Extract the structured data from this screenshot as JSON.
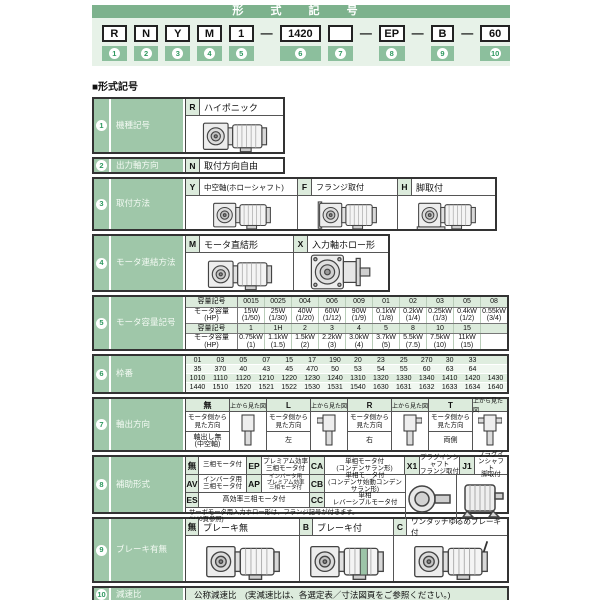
{
  "banner": {
    "title": "形 式 記 号",
    "dash": "—",
    "segments": [
      {
        "text": "R",
        "num": "1"
      },
      {
        "text": "N",
        "num": "2"
      },
      {
        "text": "Y",
        "num": "3"
      },
      {
        "text": "M",
        "num": "4"
      },
      {
        "text": "1",
        "num": "5"
      },
      {
        "text": "1420",
        "num": "6"
      },
      {
        "text": "",
        "num": "7"
      },
      {
        "text": "EP",
        "num": "8"
      },
      {
        "text": "B",
        "num": "9"
      },
      {
        "text": "60",
        "num": "10"
      }
    ]
  },
  "section_heading": "■形式記号",
  "rows": {
    "r1": {
      "num": "1",
      "label": "機種記号",
      "code": "R",
      "desc": "ハイポニック"
    },
    "r2": {
      "num": "2",
      "label": "出力軸方向",
      "code": "N",
      "desc": "取付方向自由"
    },
    "r3": {
      "num": "3",
      "label": "取付方法",
      "opts": [
        {
          "code": "Y",
          "desc": "中空軸(ホローシャフト)"
        },
        {
          "code": "F",
          "desc": "フランジ取付"
        },
        {
          "code": "H",
          "desc": "脚取付"
        }
      ]
    },
    "r4": {
      "num": "4",
      "label": "モータ連結方法",
      "opts": [
        {
          "code": "M",
          "desc": "モータ直結形"
        },
        {
          "code": "X",
          "desc": "入力軸ホロー形"
        }
      ]
    },
    "r5": {
      "num": "5",
      "label": "モータ容量記号",
      "code_label": "容量記号",
      "cap_label": "モータ容量\n(HP)",
      "codes1": [
        "0015",
        "0025",
        "004",
        "006",
        "009",
        "01",
        "02",
        "03",
        "05",
        "08"
      ],
      "caps1": [
        "15W\n(1/50)",
        "25W\n(1/30)",
        "40W\n(1/20)",
        "60W\n(1/12)",
        "90W\n(1/9)",
        "0.1kW\n(1/8)",
        "0.2kW\n(1/4)",
        "0.25kW\n(1/3)",
        "0.4kW\n(1/2)",
        "0.55kW\n(3/4)"
      ],
      "codes2": [
        "1",
        "1H",
        "2",
        "3",
        "4",
        "5",
        "8",
        "10",
        "15",
        ""
      ],
      "caps2": [
        "0.75kW\n(1)",
        "1.1kW\n(1.5)",
        "1.5kW\n(2)",
        "2.2kW\n(3)",
        "3.0kW\n(4)",
        "3.7kW\n(5)",
        "5.5kW\n(7.5)",
        "7.5kW\n(10)",
        "11kW\n(15)",
        ""
      ]
    },
    "r6": {
      "num": "6",
      "label": "枠番",
      "grid": [
        [
          "01",
          "03",
          "05",
          "07",
          "15",
          "17",
          "190",
          "20",
          "23",
          "25",
          "270",
          "30",
          "33",
          ""
        ],
        [
          "35",
          "370",
          "40",
          "43",
          "45",
          "470",
          "50",
          "53",
          "54",
          "55",
          "60",
          "63",
          "64",
          ""
        ],
        [
          "1010",
          "1110",
          "1120",
          "1210",
          "1220",
          "1230",
          "1240",
          "1310",
          "1320",
          "1330",
          "1340",
          "1410",
          "1420",
          "1430"
        ],
        [
          "1440",
          "1510",
          "1520",
          "1521",
          "1522",
          "1530",
          "1531",
          "1540",
          "1630",
          "1631",
          "1632",
          "1633",
          "1634",
          "1640"
        ]
      ]
    },
    "r7": {
      "num": "7",
      "label": "軸出方向",
      "top_view": "上から見た図",
      "motor_side": "モータ側から\n見た方向",
      "opts": [
        {
          "code": "無",
          "value": "軸出し無\n(中空軸)"
        },
        {
          "code": "L",
          "value": "左"
        },
        {
          "code": "R",
          "value": "右"
        },
        {
          "code": "T",
          "value": "両側"
        }
      ]
    },
    "r8": {
      "num": "8",
      "label": "補助形式",
      "a": [
        {
          "code": "無",
          "desc": "三相モータ付"
        },
        {
          "code": "EP",
          "desc": "プレミアム効率\n三相モータ付"
        },
        {
          "code": "CA",
          "desc": "単相モータ付\n(コンデンサラン形)"
        },
        {
          "code": "X1",
          "desc": "プラグインシャフト\nフランジ取付"
        },
        {
          "code": "J1",
          "desc": "プラグインシャフト\n脚取付"
        }
      ],
      "b": [
        {
          "code": "AV",
          "desc": "インバータ用\n三相モータ付"
        },
        {
          "code": "AP",
          "desc": "インバータ用\nプレミアム効率\n三相モータ付"
        },
        {
          "code": "CB",
          "desc": "単相モータ付\n(コンデンサ始動コンデンサラン形)"
        }
      ],
      "c": [
        {
          "code": "ES",
          "desc": "高効率三相モータ付"
        },
        {
          "code": "CC",
          "desc": "単相\nレバーシブルモータ付"
        }
      ],
      "note": "サーボモータ用入力ホロー形は、フランジ記号が付きます。\n(H40頁参照)"
    },
    "r9": {
      "num": "9",
      "label": "ブレーキ有無",
      "opts": [
        {
          "code": "無",
          "desc": "ブレーキ無"
        },
        {
          "code": "B",
          "desc": "ブレーキ付"
        },
        {
          "code": "C",
          "desc": "ワンタッチゆるめブレーキ付"
        }
      ]
    },
    "r10": {
      "num": "10",
      "label": "減速比",
      "desc": "公称減速比　(実減速比は、各選定表／寸法図頁をご参照ください。)"
    }
  }
}
